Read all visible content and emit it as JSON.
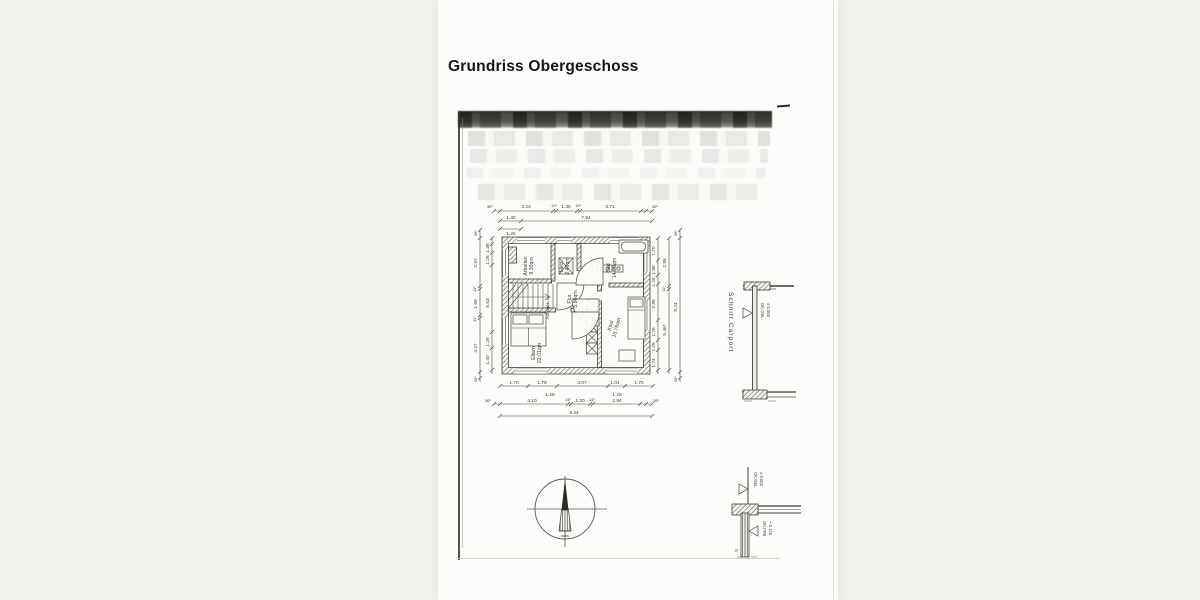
{
  "title": "Grundriss Obergeschoss",
  "plan": {
    "rooms": {
      "arbeiten": {
        "name": "Arbeiten",
        "area": "9.30qm"
      },
      "heiz": {
        "name": "Heiz.",
        "area": "2.40qm"
      },
      "bad": {
        "name": "Bad",
        "area": "14.00qm"
      },
      "flur": {
        "name": "Flur",
        "area": "5.96qm"
      },
      "eltern": {
        "name": "Eltern",
        "area": "22.01qm"
      },
      "kind": {
        "name": "Kind",
        "area": "13.76qm"
      }
    },
    "annotations": {
      "auflager": "Auflager"
    },
    "dims": {
      "top1": [
        "36⁵",
        "3.23",
        "11⁵",
        "1.30",
        "11⁵",
        "3.71",
        "36⁵"
      ],
      "top2": [
        "1.30",
        "7.94"
      ],
      "top3": [
        "1.25"
      ],
      "bot1": [
        "1.70",
        "1.76",
        "3.07",
        "1.01",
        "1.70"
      ],
      "bot1b": [
        "1.25",
        "1.25"
      ],
      "bot2": [
        "36⁵",
        "4.10",
        "11⁵",
        "1.20",
        "11⁵",
        "2.94",
        "36⁵"
      ],
      "bot3": [
        "9.24"
      ],
      "left_outer": [
        "36⁵",
        "2.97",
        "11⁵",
        "1.69",
        "11⁵",
        "4.27",
        "36⁵"
      ],
      "left_inner": [
        "1.38",
        "1.25",
        "5.53",
        "1.25",
        "1.40"
      ],
      "right_inner": [
        "1.70",
        "1.86",
        "1.25",
        "2.88",
        "1.76",
        "1.25",
        "1.74"
      ],
      "right_mid": [
        "2.95",
        "11⁵",
        "5.46⁵"
      ],
      "right_outer": [
        "36⁵",
        "9.24",
        "36⁵"
      ]
    }
  },
  "carport": {
    "label": "Schnitt Carport",
    "level_gel_top": {
      "line1": "OK.GEL.",
      "line2": "± 0.000"
    },
    "level_gel_bottom": {
      "line1": "OK.GEL.",
      "line2": "± 0.000"
    },
    "level_ffb": {
      "line1": "OK.FFB",
      "line2": "+ 0.140"
    },
    "s_mark": "S"
  }
}
